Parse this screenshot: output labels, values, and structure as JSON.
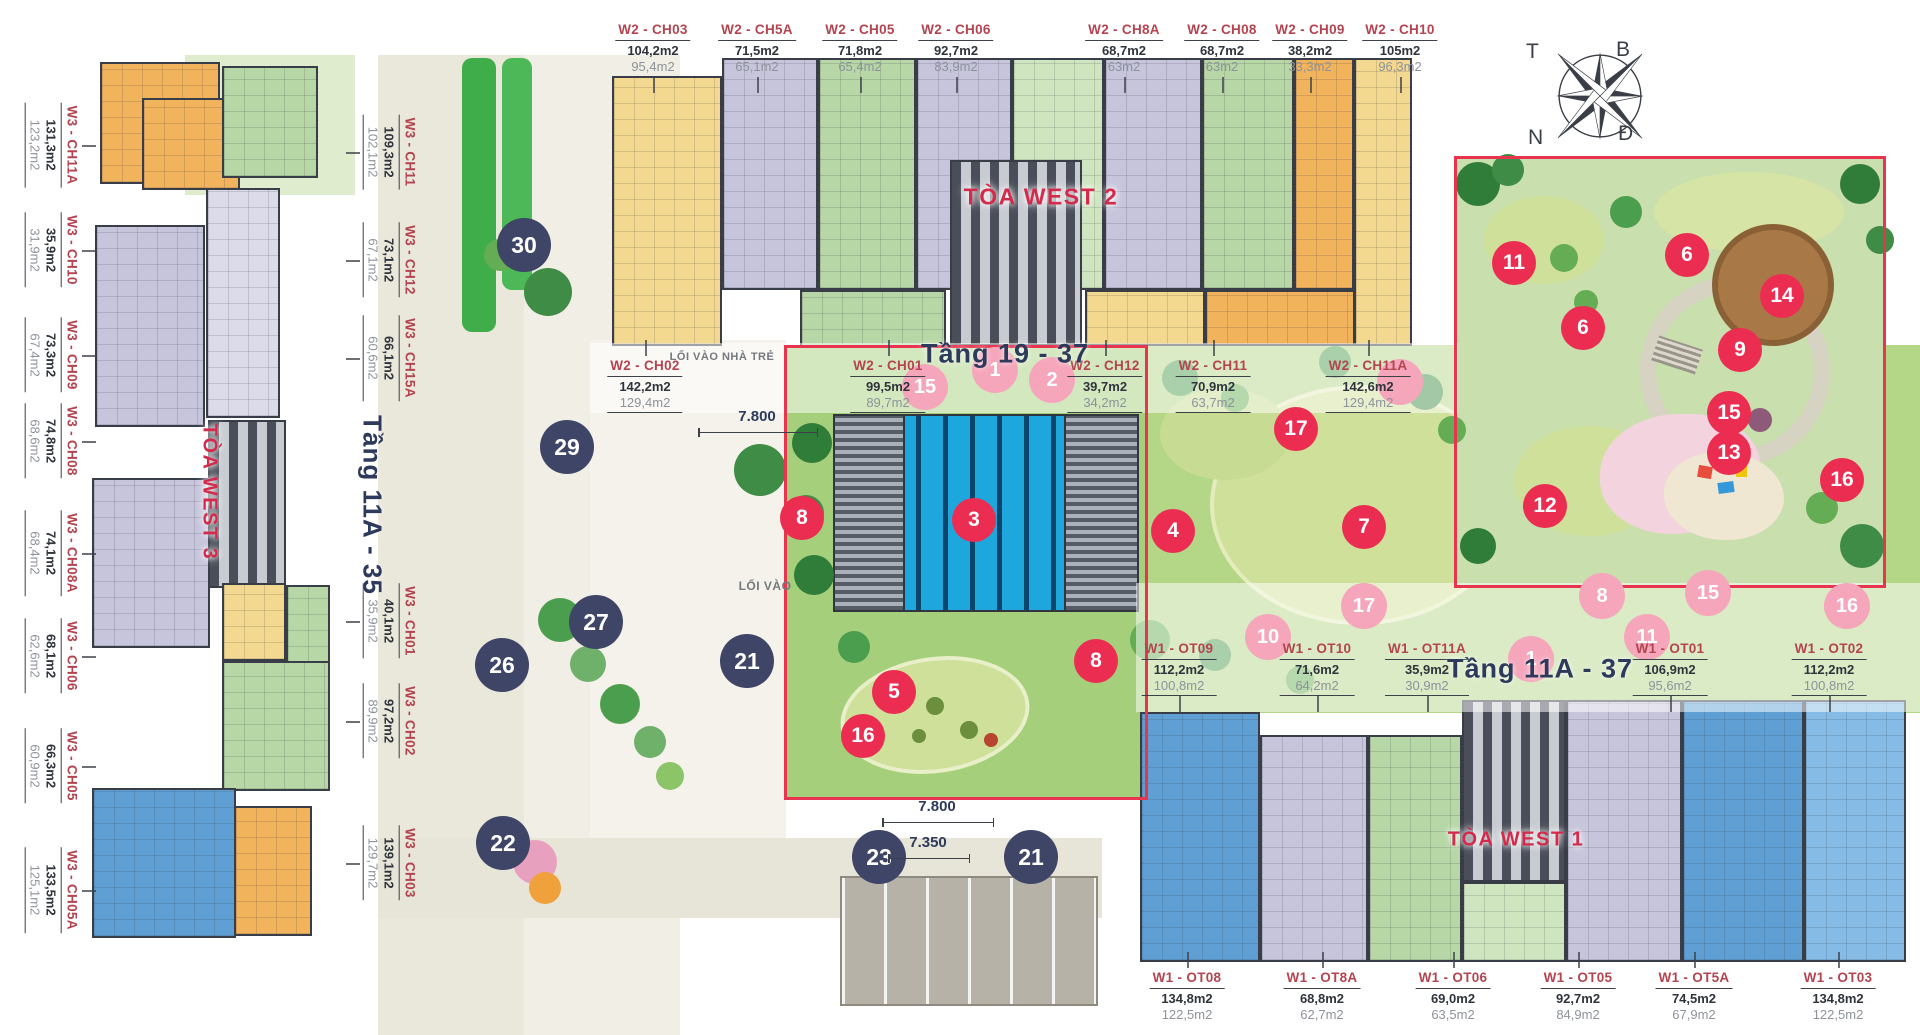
{
  "titles": {
    "west2": "TÒA WEST 2",
    "west3": "TÒA WEST 3",
    "west1": "TÒA WEST 1",
    "floors_west2": "Tầng 19 - 37",
    "floors_west3": "Tầng 11A - 35",
    "floors_west1": "Tầng 11A - 37"
  },
  "annotations": {
    "nursery_entrance": "LỐI VÀO NHÀ TRẺ",
    "entrance": "LỐI VÀO",
    "dim_top": "7.800",
    "dim_bottom1": "7.800",
    "dim_bottom2": "7.350"
  },
  "compass": {
    "west": "T",
    "north": "B",
    "south": "N",
    "east": "Đ"
  },
  "colors": {
    "accent_red": "#e8344f",
    "label_red": "#b34450",
    "title_red": "#d42b4d",
    "navy": "#2e3a5c",
    "marker_red": "#ec2d52",
    "marker_navy": "#3f4566",
    "marker_pink": "#f5a6bb",
    "pool_blue": "#1ea7dd"
  },
  "unit_groups": [
    {
      "id": "west2-top",
      "o": "h",
      "ul": false,
      "tick": "down",
      "y": 22,
      "x": 0,
      "units": [
        {
          "n": "W2 - CH03",
          "a1": "104,2m2",
          "a2": "95,4m2",
          "p": 653
        },
        {
          "n": "W2 - CH5A",
          "a1": "71,5m2",
          "a2": "65,1m2",
          "p": 757
        },
        {
          "n": "W2 - CH05",
          "a1": "71,8m2",
          "a2": "65,4m2",
          "p": 860
        },
        {
          "n": "W2 - CH06",
          "a1": "92,7m2",
          "a2": "83,9m2",
          "p": 956
        },
        {
          "n": "W2 - CH8A",
          "a1": "68,7m2",
          "a2": "63m2",
          "p": 1124
        },
        {
          "n": "W2 - CH08",
          "a1": "68,7m2",
          "a2": "63m2",
          "p": 1222
        },
        {
          "n": "W2 - CH09",
          "a1": "38,2m2",
          "a2": "33,3m2",
          "p": 1310
        },
        {
          "n": "W2 - CH10",
          "a1": "105m2",
          "a2": "96,3m2",
          "p": 1400
        }
      ]
    },
    {
      "id": "west2-mid",
      "o": "h",
      "ul": true,
      "tick": "up",
      "y": 358,
      "x": 0,
      "units": [
        {
          "n": "W2 - CH02",
          "a1": "142,2m2",
          "a2": "129,4m2",
          "p": 645
        },
        {
          "n": "W2 - CH01",
          "a1": "99,5m2",
          "a2": "89,7m2",
          "p": 888
        },
        {
          "n": "W2 - CH12",
          "a1": "39,7m2",
          "a2": "34,2m2",
          "p": 1105
        },
        {
          "n": "W2 - CH11",
          "a1": "70,9m2",
          "a2": "63,7m2",
          "p": 1213
        },
        {
          "n": "W2 - CH11A",
          "a1": "142,6m2",
          "a2": "129,4m2",
          "p": 1368
        }
      ]
    },
    {
      "id": "west1-mid",
      "o": "h",
      "ul": true,
      "tick": "down",
      "y": 641,
      "x": 0,
      "units": [
        {
          "n": "W1 - OT09",
          "a1": "112,2m2",
          "a2": "100,8m2",
          "p": 1179
        },
        {
          "n": "W1 - OT10",
          "a1": "71,6m2",
          "a2": "64,2m2",
          "p": 1317
        },
        {
          "n": "W1 - OT11A",
          "a1": "35,9m2",
          "a2": "30,9m2",
          "p": 1427
        },
        {
          "n": "W1 - OT01",
          "a1": "106,9m2",
          "a2": "95,6m2",
          "p": 1670
        },
        {
          "n": "W1 - OT02",
          "a1": "112,2m2",
          "a2": "100,8m2",
          "p": 1829
        }
      ]
    },
    {
      "id": "west1-bottom",
      "o": "h",
      "ul": false,
      "tick": "up",
      "y": 970,
      "x": 0,
      "units": [
        {
          "n": "W1 - OT08",
          "a1": "134,8m2",
          "a2": "122,5m2",
          "p": 1187
        },
        {
          "n": "W1 - OT8A",
          "a1": "68,8m2",
          "a2": "62,7m2",
          "p": 1322
        },
        {
          "n": "W1 - OT06",
          "a1": "69,0m2",
          "a2": "63,5m2",
          "p": 1453
        },
        {
          "n": "W1 - OT05",
          "a1": "92,7m2",
          "a2": "84,9m2",
          "p": 1578
        },
        {
          "n": "W1 - OT5A",
          "a1": "74,5m2",
          "a2": "67,9m2",
          "p": 1694
        },
        {
          "n": "W1 - OT03",
          "a1": "134,8m2",
          "a2": "122,5m2",
          "p": 1838
        }
      ]
    },
    {
      "id": "west3-left",
      "o": "v",
      "ul": true,
      "tick": "right",
      "y": 0,
      "x": 52,
      "units": [
        {
          "n": "W3 - CH11A",
          "a1": "131,3m2",
          "a2": "123,2m2",
          "p": 145
        },
        {
          "n": "W3 - CH10",
          "a1": "35,9m2",
          "a2": "31,9m2",
          "p": 250
        },
        {
          "n": "W3 - CH09",
          "a1": "73,3m2",
          "a2": "67,4m2",
          "p": 355
        },
        {
          "n": "W3 - CH08",
          "a1": "74,8m2",
          "a2": "68,6m2",
          "p": 441
        },
        {
          "n": "W3 - CH08A",
          "a1": "74,1m2",
          "a2": "68,4m2",
          "p": 553
        },
        {
          "n": "W3 - CH06",
          "a1": "68,1m2",
          "a2": "62,6m2",
          "p": 656
        },
        {
          "n": "W3 - CH05",
          "a1": "66,3m2",
          "a2": "60,9m2",
          "p": 766
        },
        {
          "n": "W3 - CH05A",
          "a1": "133,5m2",
          "a2": "125,1m2",
          "p": 890
        }
      ]
    },
    {
      "id": "west3-inner",
      "o": "v",
      "ul": true,
      "tick": "left",
      "y": 0,
      "x": 390,
      "units": [
        {
          "n": "W3 - CH11",
          "a1": "109,3m2",
          "a2": "102,1m2",
          "p": 152
        },
        {
          "n": "W3 - CH12",
          "a1": "73,1m2",
          "a2": "67,1m2",
          "p": 260
        },
        {
          "n": "W3 - CH15A",
          "a1": "66,1m2",
          "a2": "60,6m2",
          "p": 358
        },
        {
          "n": "W3 - CH01",
          "a1": "40,1m2",
          "a2": "35,9m2",
          "p": 621
        },
        {
          "n": "W3 - CH02",
          "a1": "97,2m2",
          "a2": "89,9m2",
          "p": 721
        },
        {
          "n": "W3 - CH03",
          "a1": "139,1m2",
          "a2": "129,7m2",
          "p": 863
        }
      ]
    }
  ],
  "markers": [
    {
      "n": "30",
      "x": 524,
      "y": 245,
      "k": "navy"
    },
    {
      "n": "29",
      "x": 567,
      "y": 447,
      "k": "navy"
    },
    {
      "n": "27",
      "x": 596,
      "y": 622,
      "k": "navy"
    },
    {
      "n": "26",
      "x": 502,
      "y": 665,
      "k": "navy"
    },
    {
      "n": "21",
      "x": 747,
      "y": 661,
      "k": "navy"
    },
    {
      "n": "22",
      "x": 503,
      "y": 843,
      "k": "navy"
    },
    {
      "n": "23",
      "x": 879,
      "y": 857,
      "k": "navy"
    },
    {
      "n": "21",
      "x": 1031,
      "y": 857,
      "k": "navy"
    },
    {
      "n": "11",
      "x": 1514,
      "y": 263,
      "k": "red"
    },
    {
      "n": "6",
      "x": 1687,
      "y": 255,
      "k": "red"
    },
    {
      "n": "14",
      "x": 1782,
      "y": 296,
      "k": "red"
    },
    {
      "n": "6",
      "x": 1583,
      "y": 328,
      "k": "red"
    },
    {
      "n": "9",
      "x": 1740,
      "y": 350,
      "k": "red"
    },
    {
      "n": "15",
      "x": 1729,
      "y": 413,
      "k": "red"
    },
    {
      "n": "13",
      "x": 1729,
      "y": 453,
      "k": "red"
    },
    {
      "n": "16",
      "x": 1842,
      "y": 480,
      "k": "red"
    },
    {
      "n": "12",
      "x": 1545,
      "y": 506,
      "k": "red"
    },
    {
      "n": "17",
      "x": 1296,
      "y": 429,
      "k": "red"
    },
    {
      "n": "7",
      "x": 1364,
      "y": 527,
      "k": "red"
    },
    {
      "n": "4",
      "x": 1173,
      "y": 531,
      "k": "red"
    },
    {
      "n": "3",
      "x": 974,
      "y": 520,
      "k": "red"
    },
    {
      "n": "8",
      "x": 802,
      "y": 518,
      "k": "red"
    },
    {
      "n": "8",
      "x": 1096,
      "y": 661,
      "k": "red"
    },
    {
      "n": "5",
      "x": 894,
      "y": 692,
      "k": "red"
    },
    {
      "n": "16",
      "x": 863,
      "y": 736,
      "k": "red"
    },
    {
      "n": "15",
      "x": 925,
      "y": 387,
      "k": "pink"
    },
    {
      "n": "1",
      "x": 995,
      "y": 370,
      "k": "pink"
    },
    {
      "n": "2",
      "x": 1052,
      "y": 380,
      "k": "pink"
    },
    {
      "n": "",
      "x": 1400,
      "y": 382,
      "k": "pink"
    },
    {
      "n": "17",
      "x": 1364,
      "y": 606,
      "k": "pink"
    },
    {
      "n": "8",
      "x": 1602,
      "y": 596,
      "k": "pink"
    },
    {
      "n": "15",
      "x": 1708,
      "y": 593,
      "k": "pink"
    },
    {
      "n": "16",
      "x": 1847,
      "y": 606,
      "k": "pink"
    },
    {
      "n": "10",
      "x": 1268,
      "y": 637,
      "k": "pink"
    },
    {
      "n": "11",
      "x": 1647,
      "y": 637,
      "k": "pink"
    },
    {
      "n": "1",
      "x": 1531,
      "y": 659,
      "k": "pink"
    }
  ]
}
